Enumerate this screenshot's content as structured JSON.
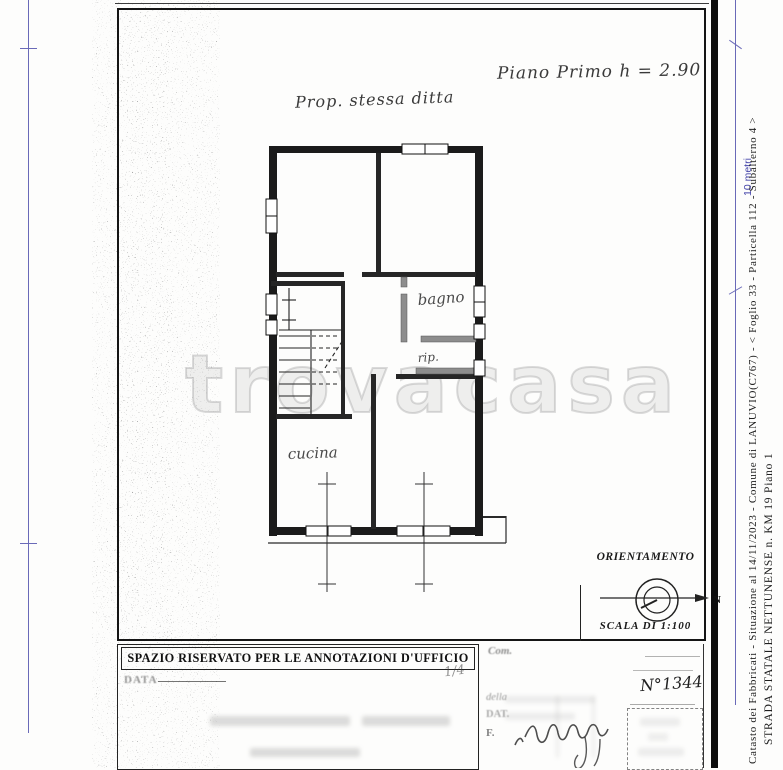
{
  "page": {
    "watermark": "trovacasa"
  },
  "plan": {
    "note_property": "Prop. stessa ditta",
    "note_floor": "Piano Primo h = 2.90",
    "rooms": {
      "bagno": "bagno",
      "rip": "rip.",
      "cucina": "cucina"
    }
  },
  "orientation": {
    "title": "ORIENTAMENTO",
    "north": "N",
    "scale": "SCALA DI 1:100"
  },
  "office_box": {
    "header": "SPAZIO RISERVATO PER LE ANNOTAZIONI D'UFFICIO",
    "data_label": "DATA",
    "mark": "1/4"
  },
  "right_form": {
    "com": "Com.",
    "della": "della",
    "dat": "DAT.",
    "f": "F.",
    "doc_number": "N°1344"
  },
  "margin": {
    "ruler_label": "10 metri",
    "catasto": "Catasto dei Fabbricati - Situazione al 14/11/2023 - Comune di LANUVIO(C767) - <  Foglio 33 - Particella  112 - Subalterno 4 >",
    "address": "STRADA STATALE NETTUNENSE n. KM 19 Piano 1"
  }
}
